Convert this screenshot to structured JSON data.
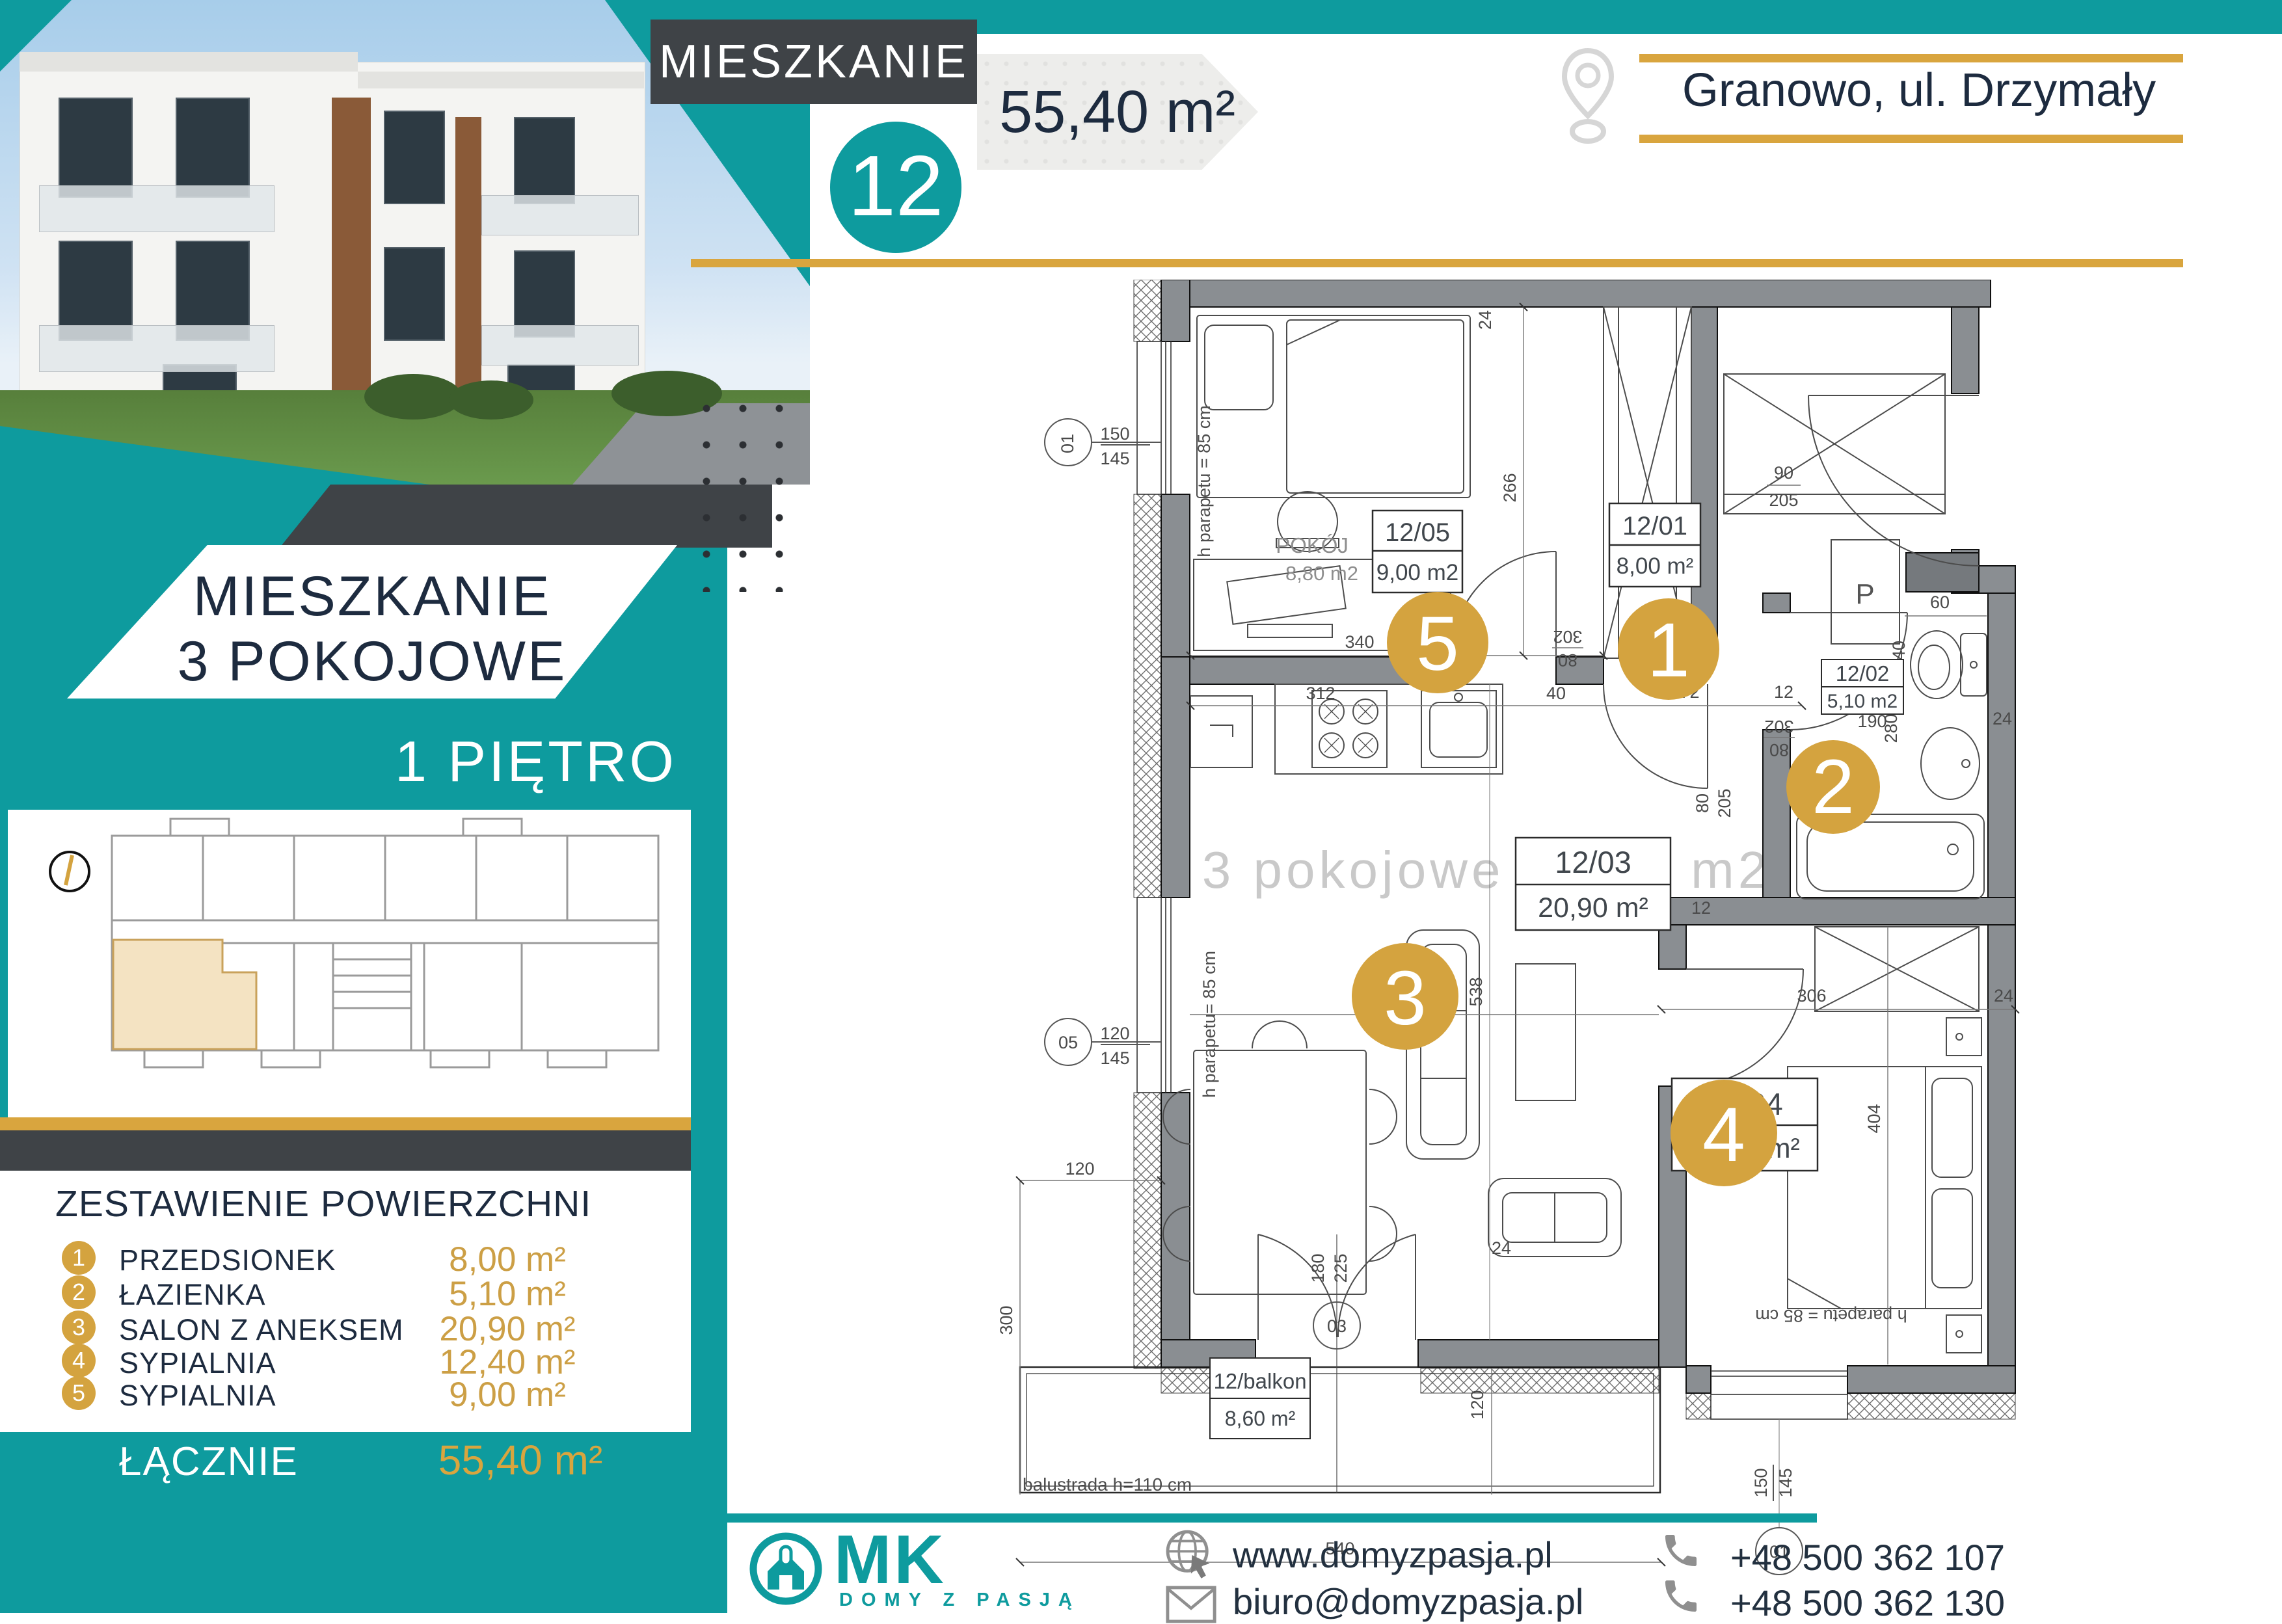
{
  "header": {
    "label": "MIESZKANIE",
    "number": "12",
    "area": "55,40 m²",
    "location": "Granowo, ul. Drzymały"
  },
  "sidebar": {
    "title_line1": "MIESZKANIE",
    "title_line2": "3 POKOJOWE",
    "floor": "1 PIĘTRO",
    "summary_title": "ZESTAWIENIE POWIERZCHNI",
    "rooms": [
      {
        "no": "1",
        "name": "PRZEDSIONEK",
        "area": "8,00 m²"
      },
      {
        "no": "2",
        "name": "ŁAZIENKA",
        "area": "5,10 m²"
      },
      {
        "no": "3",
        "name": "SALON Z ANEKSEM",
        "area": "20,90 m²"
      },
      {
        "no": "4",
        "name": "SYPIALNIA",
        "area": "12,40 m²"
      },
      {
        "no": "5",
        "name": "SYPIALNIA",
        "area": "9,00 m²"
      }
    ],
    "total_label": "ŁĄCZNIE",
    "total_area": "55,40 m²"
  },
  "plan": {
    "watermark": "3 pokojowe  55,40 m2",
    "rooms": [
      {
        "id": "12/01",
        "area": "8,00 m²",
        "badge": "1"
      },
      {
        "id": "12/02",
        "area": "5,10 m2",
        "badge": "2"
      },
      {
        "id": "12/03",
        "area": "20,90 m²",
        "badge": "3"
      },
      {
        "id": "12/04",
        "area": "12,40 m²",
        "badge": "4"
      },
      {
        "id": "12/05",
        "area": "9,00 m2",
        "badge": "5"
      }
    ],
    "room5_name": "POKÓJ",
    "room5_area": "8,80 m2",
    "balcony_id": "12/balkon",
    "balcony_area": "8,60 m²",
    "balustrade": "balustrada h=110 cm",
    "parapet_a": "h parapetu = 85 cm",
    "parapet_b": "h parapetu= 85 cm",
    "washer": "P",
    "dims": {
      "w340": "340",
      "w266": "266",
      "t24a": "24",
      "w312": "312",
      "w40": "40",
      "w172": "172",
      "t12a": "12",
      "t12b": "12",
      "door90": "90",
      "door205": "205",
      "door302a": "302",
      "door80a": "80",
      "door302b": "302",
      "door80b": "80",
      "w60": "60",
      "t40": "40",
      "t24b": "24",
      "w190": "190",
      "w280": "280",
      "door80c": "80",
      "door205c": "205",
      "w538": "538",
      "w408": "408",
      "w306": "306",
      "w404": "404",
      "t24c": "24",
      "w120a": "120",
      "w300": "300",
      "door180": "180",
      "door225": "225",
      "w120b": "120",
      "w540": "540",
      "t24d": "24",
      "win150a": "150",
      "win145a": "145",
      "win120": "120",
      "win145b": "145",
      "win150c": "150",
      "win145d": "145"
    },
    "axis": {
      "a01a": "01",
      "a05": "05",
      "a03": "03",
      "a01b": "01"
    }
  },
  "footer": {
    "brand": "MK",
    "brand_sub": "DOMY Z PASJĄ",
    "website": "www.domyzpasja.pl",
    "email": "biuro@domyzpasja.pl",
    "phone1": "+48 500 362 107",
    "phone2": "+48 500 362 130"
  }
}
